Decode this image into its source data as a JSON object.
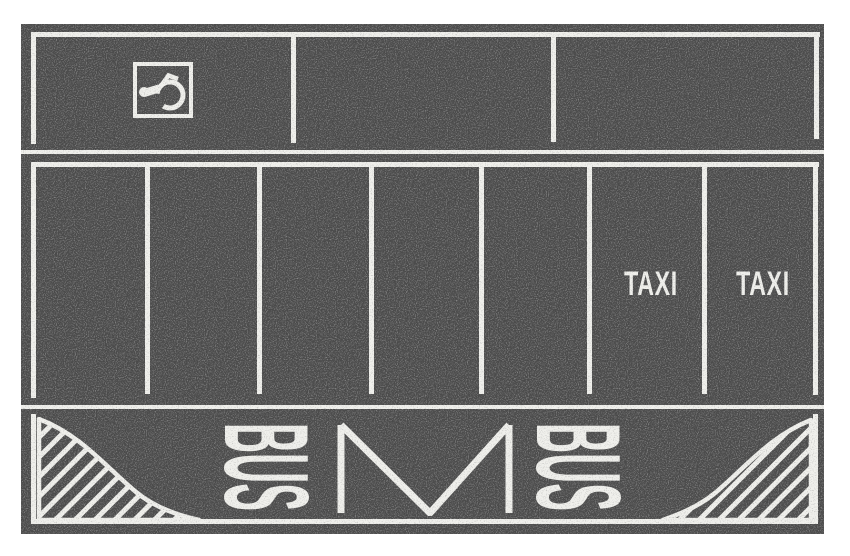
{
  "title": "Parking lot marking sheet",
  "colors": {
    "asphalt": "#4a4a4a",
    "marking": "#f0f0ec",
    "page_background": "#ffffff"
  },
  "top_row": {
    "bay_count": 3,
    "handicap_bay": {
      "icon": "wheelchair-icon",
      "position": "first bay"
    }
  },
  "middle_row": {
    "bay_count": 7,
    "taxi_labels": [
      {
        "bay": 6,
        "text": "TAXI"
      },
      {
        "bay": 7,
        "text": "TAXI"
      }
    ]
  },
  "bus_lane": {
    "left_label": "BUS",
    "right_label": "BUS",
    "center_symbol": "M",
    "corner_zones": "diagonal-hatch"
  }
}
